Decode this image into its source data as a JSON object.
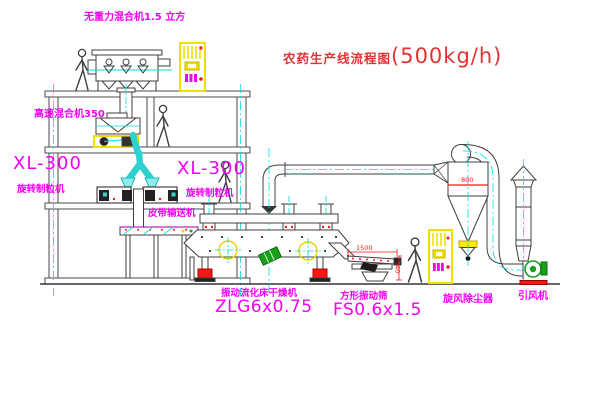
{
  "title": {
    "cn": "农药生产线流程图",
    "capacity": "(500kg/h)"
  },
  "labels": {
    "gravity_mixer": "无重力混合机1.5 立方",
    "high_speed_mixer": "高速混合机350",
    "granulator_left_model": "XL-300",
    "granulator_left_name": "旋转制粒机",
    "granulator_right_model": "XL-300",
    "granulator_right_name": "旋转制粒机",
    "belt_conveyor": "皮带输送机",
    "dryer_name": "振动流化床干燥机",
    "dryer_model": "ZLG6x0.75",
    "sieve_name": "方形振动筛",
    "sieve_model": "FS0.6x1.5",
    "cyclone": "旋风除尘器",
    "fan": "引风机"
  },
  "dimensions": {
    "sieve_length": "1500",
    "sieve_height": "540",
    "cyclone_diameter": "800"
  },
  "colors": {
    "label_magenta": "#f400f4",
    "title_red": "#e23333",
    "dimension_red": "#ff1515",
    "centerline_cyan": "#00dede",
    "chute_cyan": "#2fd0d0",
    "cabinet_yellow": "#f0e000",
    "fan_green": "#18a018",
    "foot_red": "#ff1515",
    "line_dark": "#3f3f3f"
  }
}
